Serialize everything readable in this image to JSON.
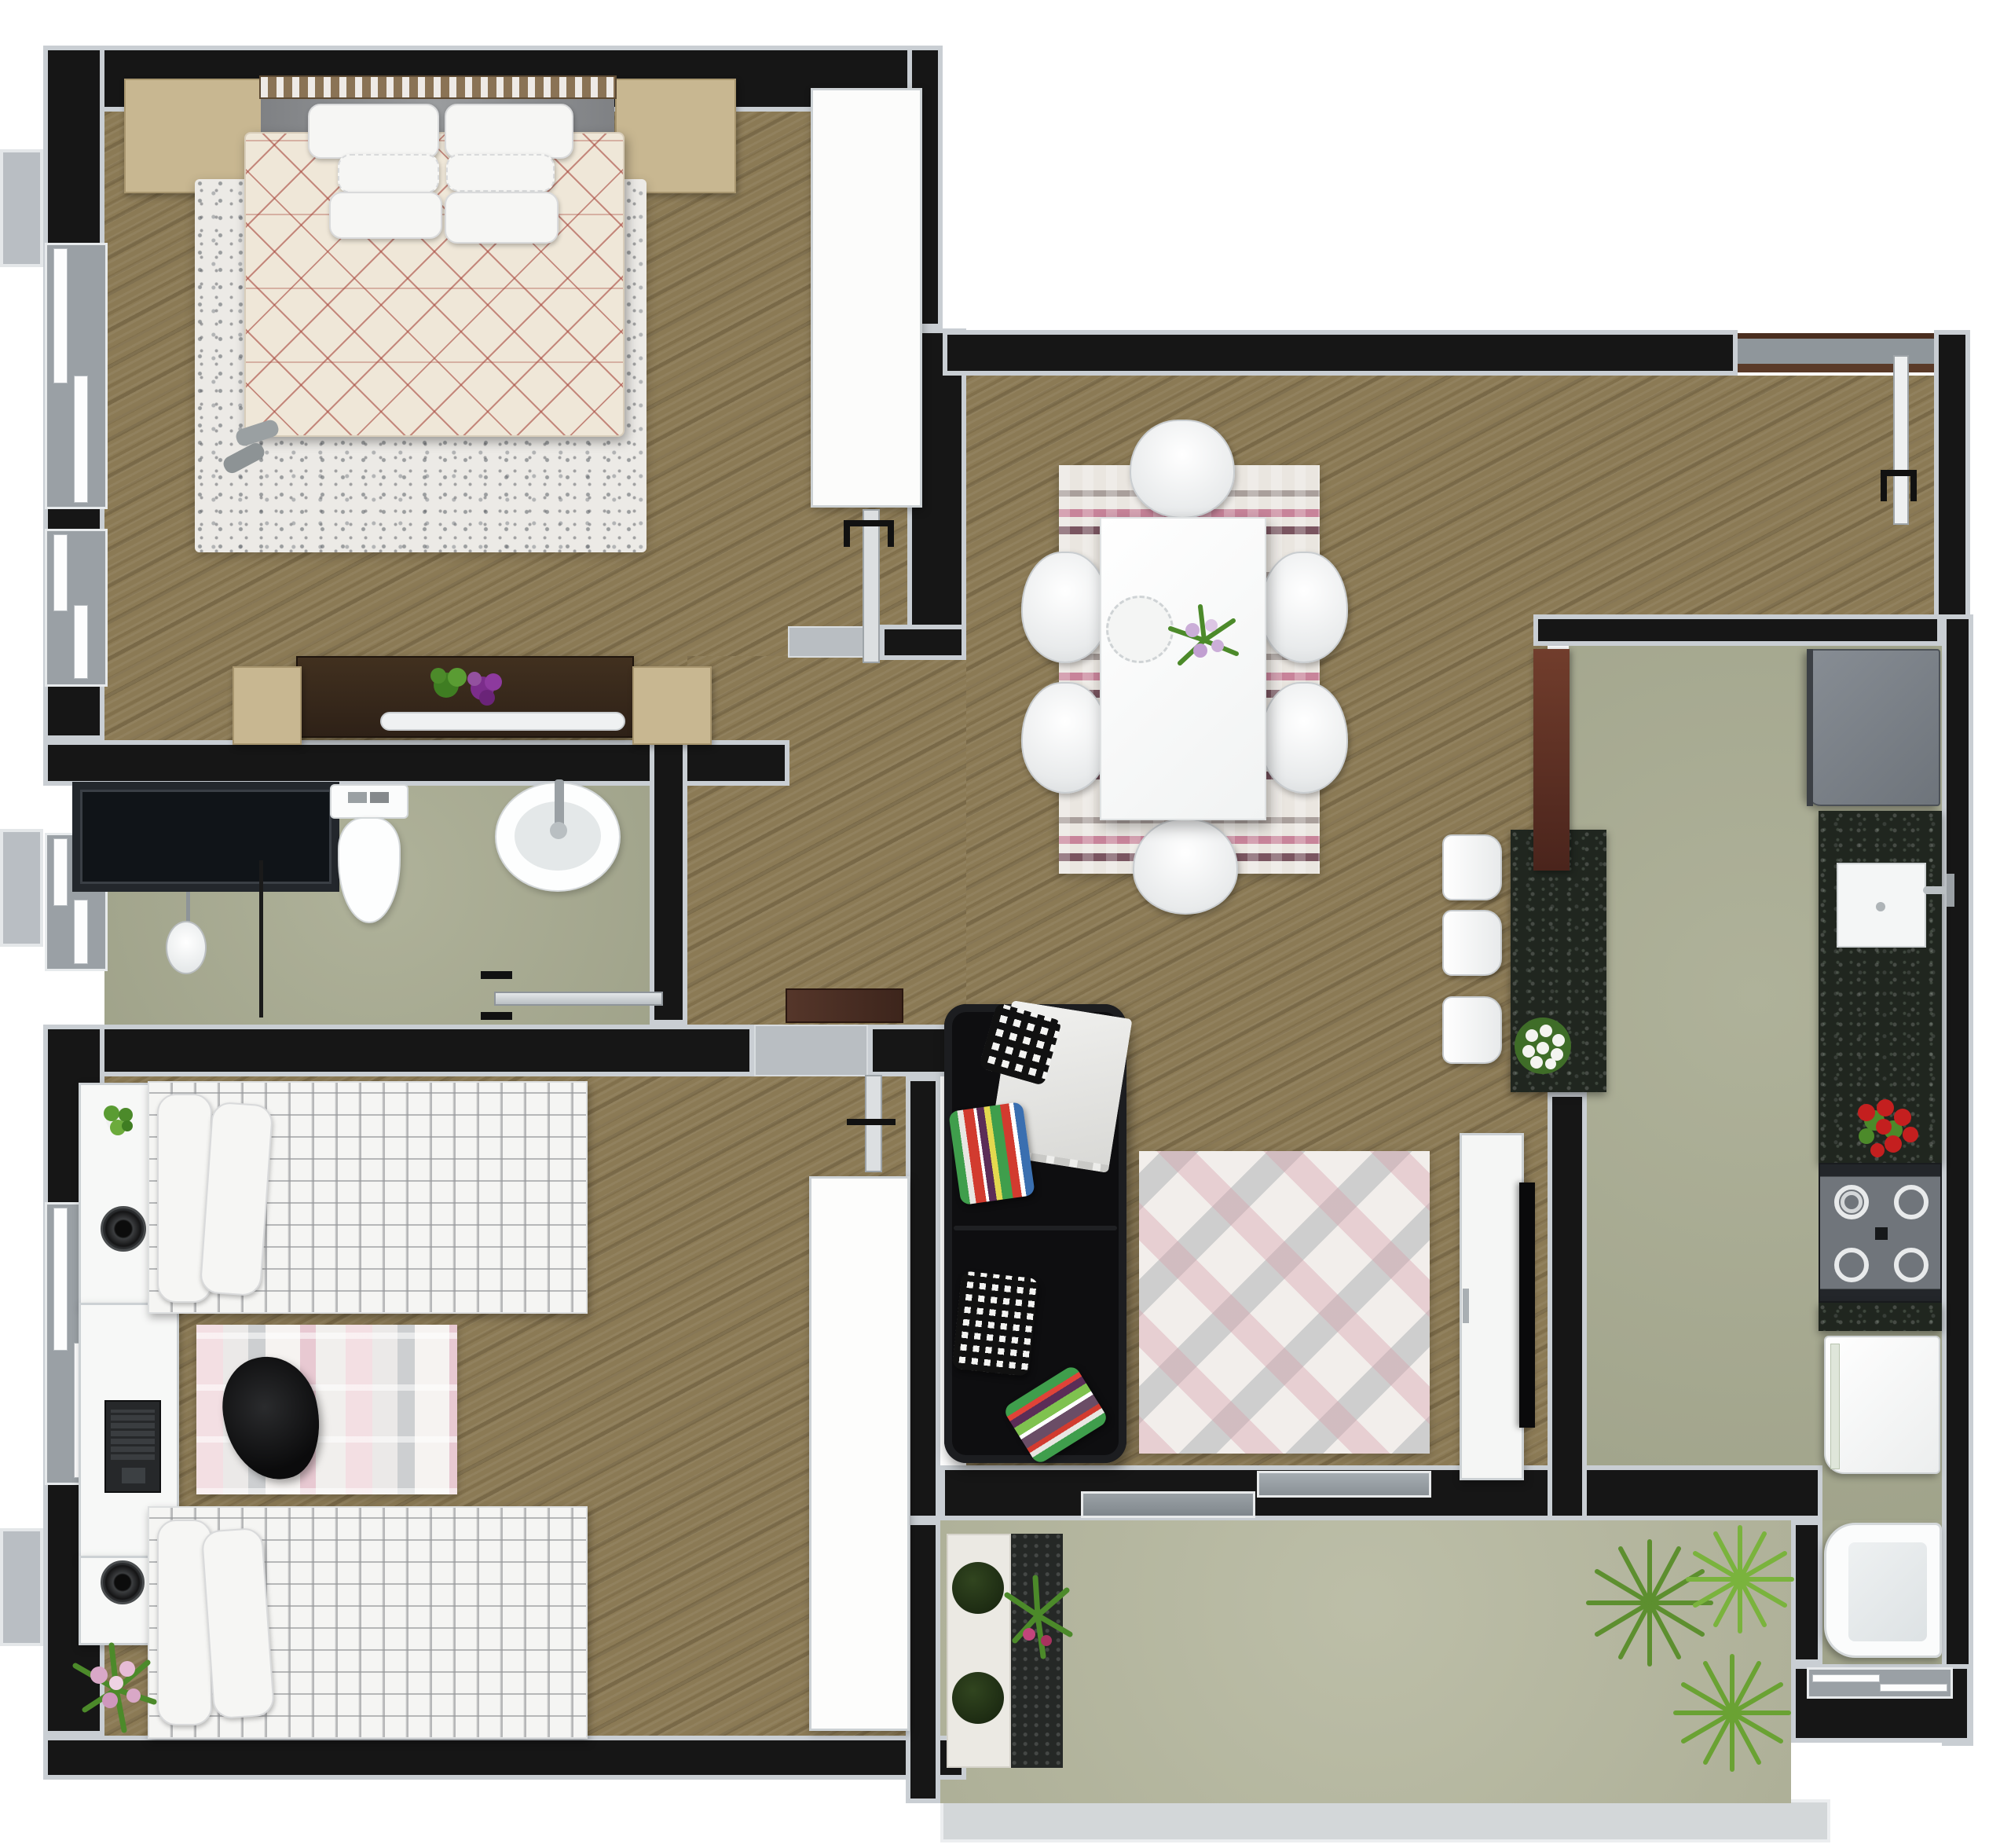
{
  "palette": {
    "outside": "#ffffff",
    "wall": "#161616",
    "trim": "#c9ced3",
    "wood": "#8b7a55",
    "sage": "#a9ac92",
    "sage-light": "#b5b79e",
    "deck": "#d3d7d9",
    "granite": "#20261f",
    "white-furniture": "#f7f8f7",
    "tan": "#c8b791",
    "dark-dresser": "#37281e",
    "headboard": "#8a7355",
    "duvet": "#efe7d8",
    "duvet-lines": "#a8493f",
    "rug-gray": "#eceae6",
    "rug-dining": "#eae6e0",
    "rug-living": "#f2eeeb",
    "sofa": "#0e0e10",
    "door-brown": "#5e3327",
    "window-glass": "#9aa0a5",
    "stove": "#70757b",
    "fridge": "#7d838a",
    "plant-green": "#6aa233",
    "flower-red": "#c41f1f",
    "flower-pink": "#d9a8c7",
    "flower-purple": "#7b2d8b"
  },
  "rooms": [
    {
      "name": "master-bedroom",
      "floor": "wood",
      "furniture": [
        "double-bed",
        "headboard",
        "pillows",
        "nightstand-left",
        "nightstand-right",
        "shag-rug",
        "slippers",
        "dresser",
        "decor-plate",
        "flower-vase",
        "stool-left",
        "stool-right",
        "wardrobe-closet",
        "window-left-1",
        "window-left-2",
        "door"
      ]
    },
    {
      "name": "bathroom",
      "floor": "sage",
      "furniture": [
        "shower-box",
        "pendant-shower-head",
        "glass-partition",
        "toilet",
        "oval-sink",
        "faucet",
        "towel-rail-door",
        "window-left"
      ]
    },
    {
      "name": "kids-bedroom",
      "floor": "wood",
      "furniture": [
        "single-bed-top",
        "single-bed-bottom",
        "side-table-1",
        "desk",
        "laptop",
        "speaker-1",
        "speaker-2",
        "striped-rug",
        "black-chair",
        "wardrobe",
        "plant-pot",
        "flower-pot",
        "window-left",
        "door"
      ]
    },
    {
      "name": "dining-living-room",
      "floor": "wood",
      "furniture": [
        "dining-table",
        "cake-stand",
        "table-flowers",
        "dining-chairs-x6",
        "striped-dining-rug",
        "black-sofa",
        "striped-pillow-1",
        "striped-pillow-2",
        "checkered-pillow-1",
        "checkered-pillow-2",
        "white-throw",
        "diamond-rug",
        "tv-stand",
        "tv",
        "entry-door",
        "sliding-balcony-door"
      ]
    },
    {
      "name": "kitchen",
      "floor": "sage",
      "furniture": [
        "breakfast-bar",
        "bar-stools-x3",
        "white-bouquet",
        "fridge",
        "granite-counter",
        "sink",
        "faucet",
        "red-flowers",
        "gas-stove-4-burners",
        "washing-machine",
        "laundry-tub",
        "window-bottom",
        "door-brown"
      ]
    },
    {
      "name": "balcony",
      "floor": "sage-light",
      "furniture": [
        "planter-tray",
        "boxwood-ball-1",
        "boxwood-ball-2",
        "pink-plant",
        "yucca-plants",
        "deck-edge"
      ]
    }
  ]
}
